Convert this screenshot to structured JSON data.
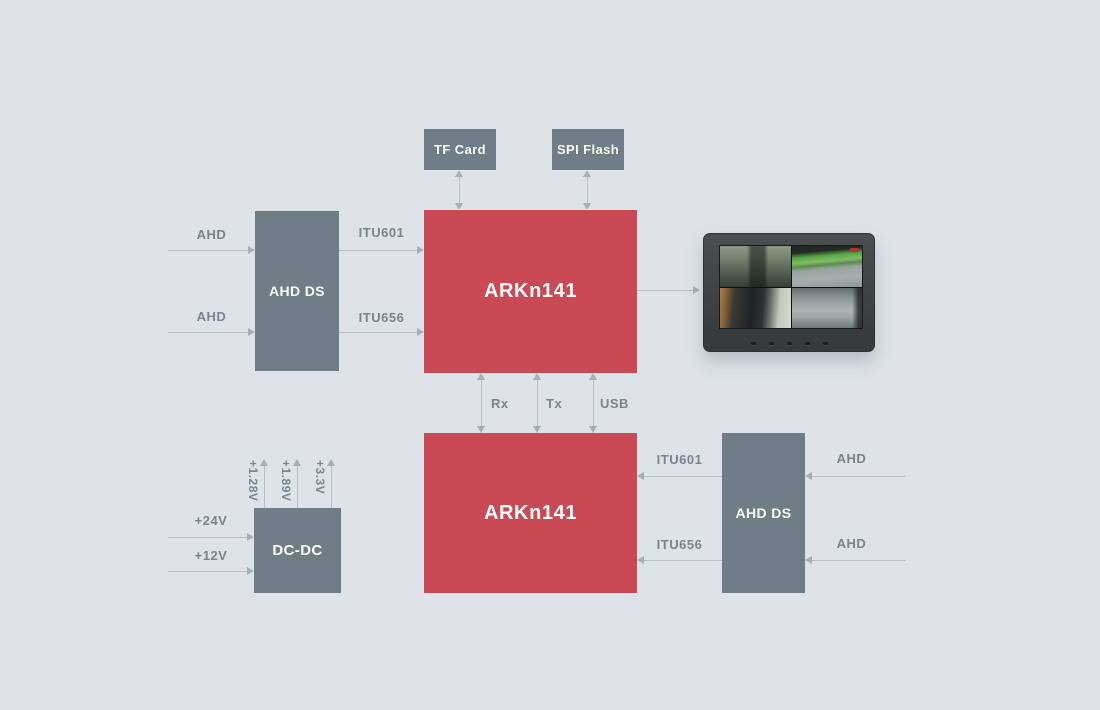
{
  "palette": {
    "background": "#dde3e9",
    "block_gray": "#6f7e86",
    "block_red": "#c94a54",
    "label_text": "#78858f",
    "arrow_line": "#b7bec4",
    "arrow_head": "#a6afb7",
    "block_text": "#fbfbfb"
  },
  "blocks": {
    "tf_card": {
      "label": "TF Card"
    },
    "spi_flash": {
      "label": "SPI Flash"
    },
    "ahd_ds_top": {
      "label": "AHD DS"
    },
    "soc_top": {
      "label": "ARKn141"
    },
    "soc_bottom": {
      "label": "ARKn141"
    },
    "ahd_ds_bottom": {
      "label": "AHD DS"
    },
    "dc_dc": {
      "label": "DC-DC"
    }
  },
  "labels": {
    "ahd_top_1": "AHD",
    "ahd_top_2": "AHD",
    "itu601_top": "ITU601",
    "itu656_top": "ITU656",
    "rx": "Rx",
    "tx": "Tx",
    "usb": "USB",
    "itu601_bottom": "ITU601",
    "itu656_bottom": "ITU656",
    "ahd_right_1": "AHD",
    "ahd_right_2": "AHD",
    "v24": "+24V",
    "v12": "+12V",
    "v1_28": "+1.28V",
    "v1_89": "+1.89V",
    "v3_3": "+3.3V"
  },
  "monitor": {
    "type": "quad-view-display",
    "feeds": [
      "bus-interior-front-cam",
      "bus-exterior-top-cam",
      "bus-interior-rear-cam",
      "road-view-cam"
    ],
    "button_count": 5
  }
}
